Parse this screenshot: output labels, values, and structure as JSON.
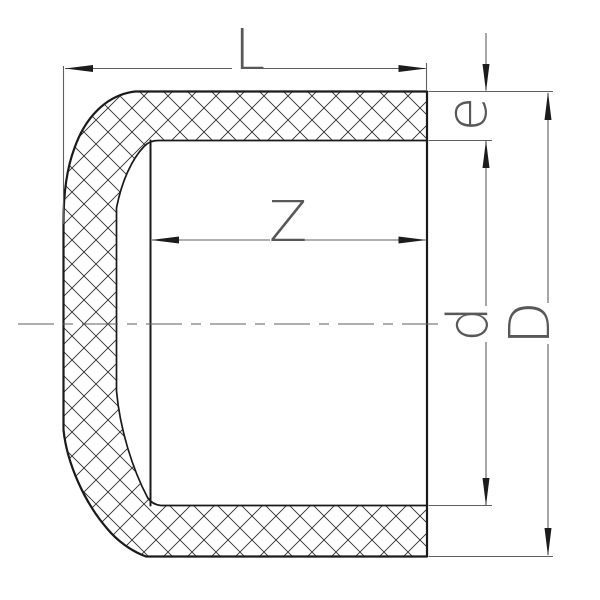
{
  "drawing": {
    "type_note": "pipe-end-cap-cross-section",
    "labels": {
      "overall_length": "L",
      "socket_depth": "Z",
      "wall_thickness": "e",
      "inner_diameter": "d",
      "outer_diameter": "D"
    },
    "colors": {
      "background": "#ffffff",
      "outline": "#1a1a1a",
      "hatch": "#2e2e2e",
      "dimension": "#5f5f5f",
      "arrow": "#1c1c1c",
      "label": "#585858"
    }
  }
}
